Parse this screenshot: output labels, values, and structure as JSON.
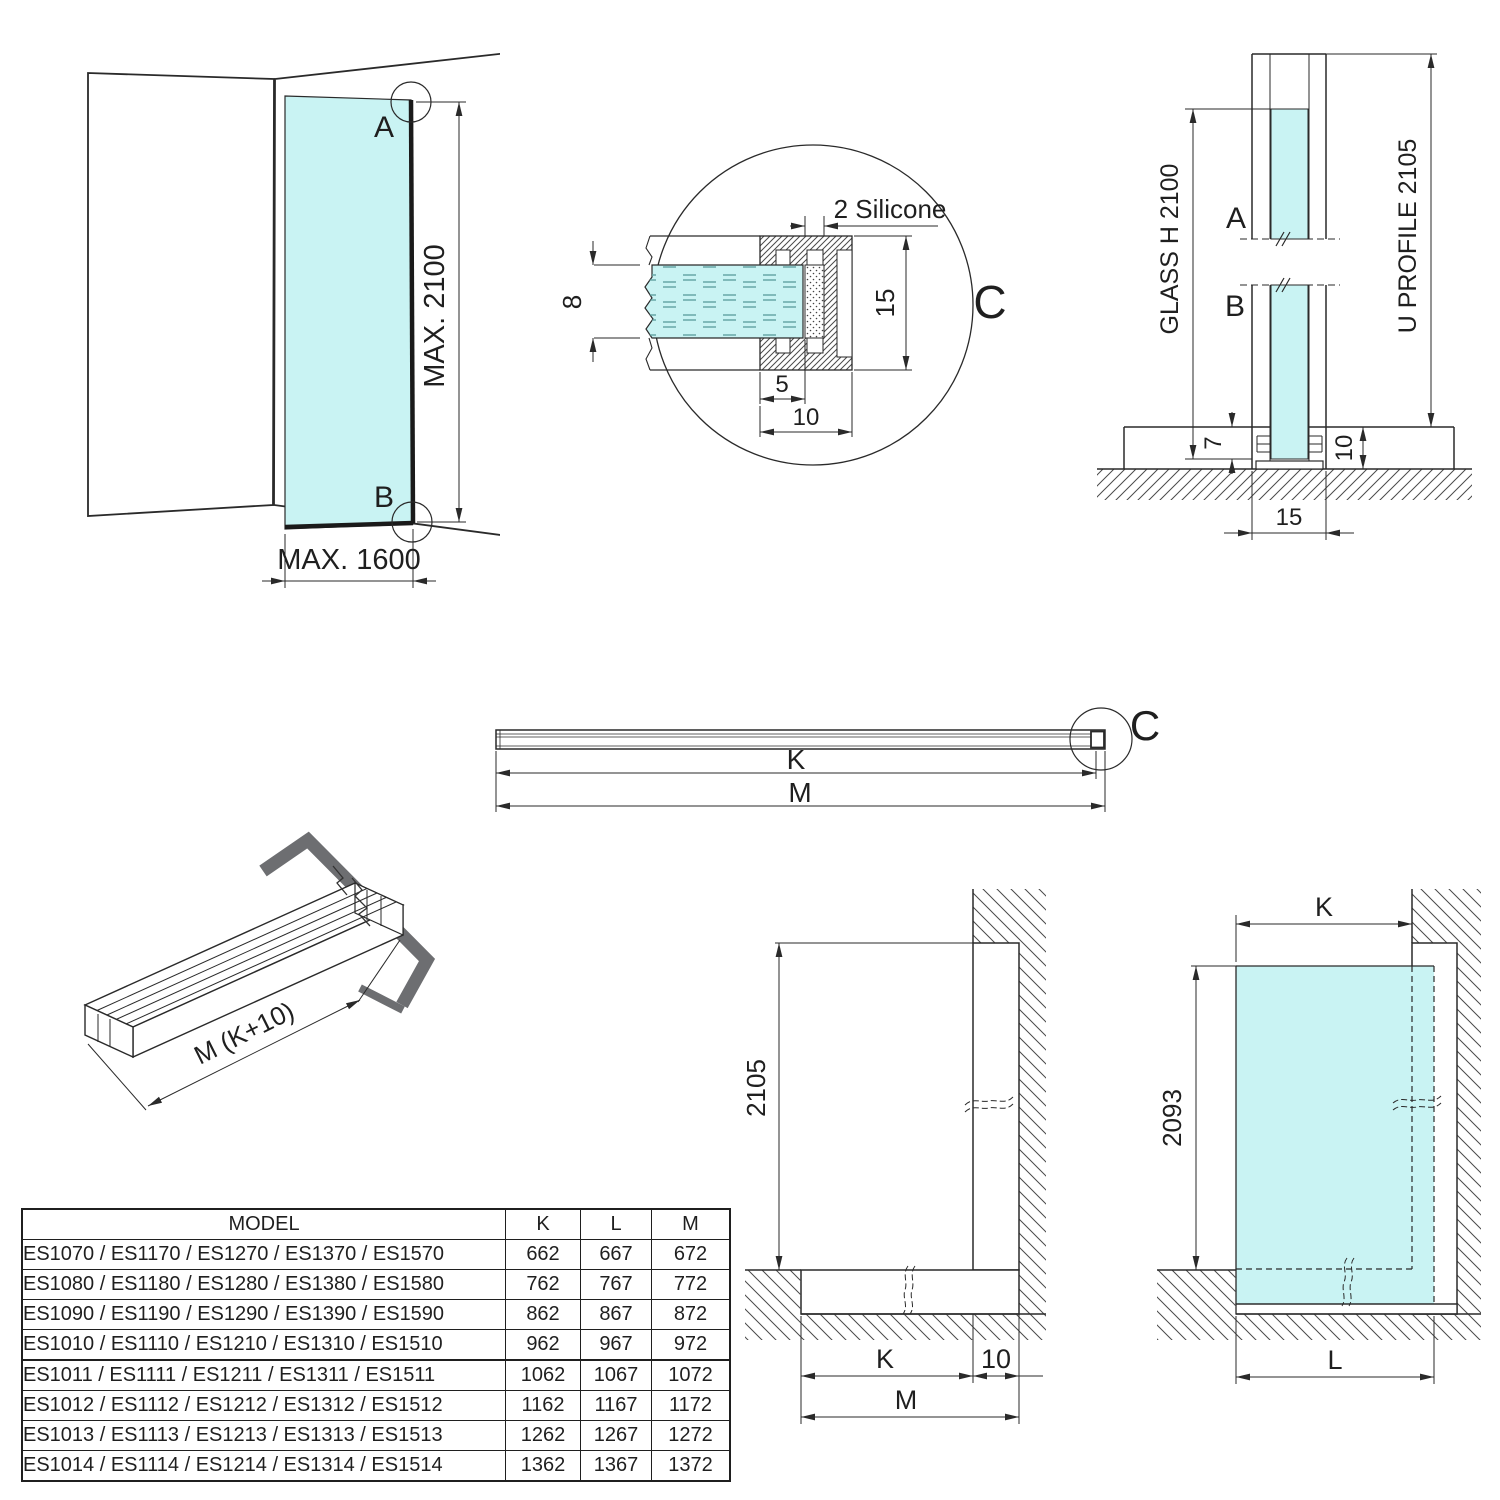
{
  "colors": {
    "glass": "#c9f3f3",
    "line": "#2a2a2a",
    "angle_gray": "#6d6e71"
  },
  "fig_corner": {
    "label_a": "A",
    "label_b": "B",
    "dim_height": "MAX. 2100",
    "dim_width": "MAX. 1600"
  },
  "fig_detail": {
    "label": "C",
    "silicone_label": "2 Silicone",
    "dim_glass_thickness": "8",
    "dim_profile_height": "15",
    "dim_inner_width": "5",
    "dim_outer_width": "10"
  },
  "fig_section": {
    "label_a": "A",
    "label_b": "B",
    "dim_glass_height": "GLASS H 2100",
    "dim_profile_length": "U PROFILE 2105",
    "dim_glass_inset": "7",
    "dim_profile_height": "10",
    "dim_profile_width": "15"
  },
  "fig_bar": {
    "label": "C",
    "dim_k": "K",
    "dim_m": "M"
  },
  "fig_profile_3d": {
    "dim_length": "M (K+10)"
  },
  "fig_front_left": {
    "dim_height": "2105",
    "dim_k": "K",
    "dim_offset": "10",
    "dim_m": "M"
  },
  "fig_front_right": {
    "dim_k": "K",
    "dim_height": "2093",
    "dim_l": "L"
  },
  "table": {
    "headers": [
      "MODEL",
      "K",
      "L",
      "M"
    ],
    "rows": [
      {
        "model": "ES1070 / ES1170 / ES1270 / ES1370 / ES1570",
        "k": "662",
        "l": "667",
        "m": "672"
      },
      {
        "model": "ES1080 / ES1180 / ES1280 / ES1380 / ES1580",
        "k": "762",
        "l": "767",
        "m": "772"
      },
      {
        "model": "ES1090 / ES1190 / ES1290 / ES1390 / ES1590",
        "k": "862",
        "l": "867",
        "m": "872"
      },
      {
        "model": "ES1010 / ES1110 / ES1210 / ES1310 / ES1510",
        "k": "962",
        "l": "967",
        "m": "972"
      },
      {
        "model": "ES1011 / ES1111 / ES1211 / ES1311 / ES1511",
        "k": "1062",
        "l": "1067",
        "m": "1072"
      },
      {
        "model": "ES1012 / ES1112 / ES1212 / ES1312 / ES1512",
        "k": "1162",
        "l": "1167",
        "m": "1172"
      },
      {
        "model": "ES1013 / ES1113 / ES1213 / ES1313 / ES1513",
        "k": "1262",
        "l": "1267",
        "m": "1272"
      },
      {
        "model": "ES1014 / ES1114 / ES1214 / ES1314 / ES1514",
        "k": "1362",
        "l": "1367",
        "m": "1372"
      }
    ]
  }
}
